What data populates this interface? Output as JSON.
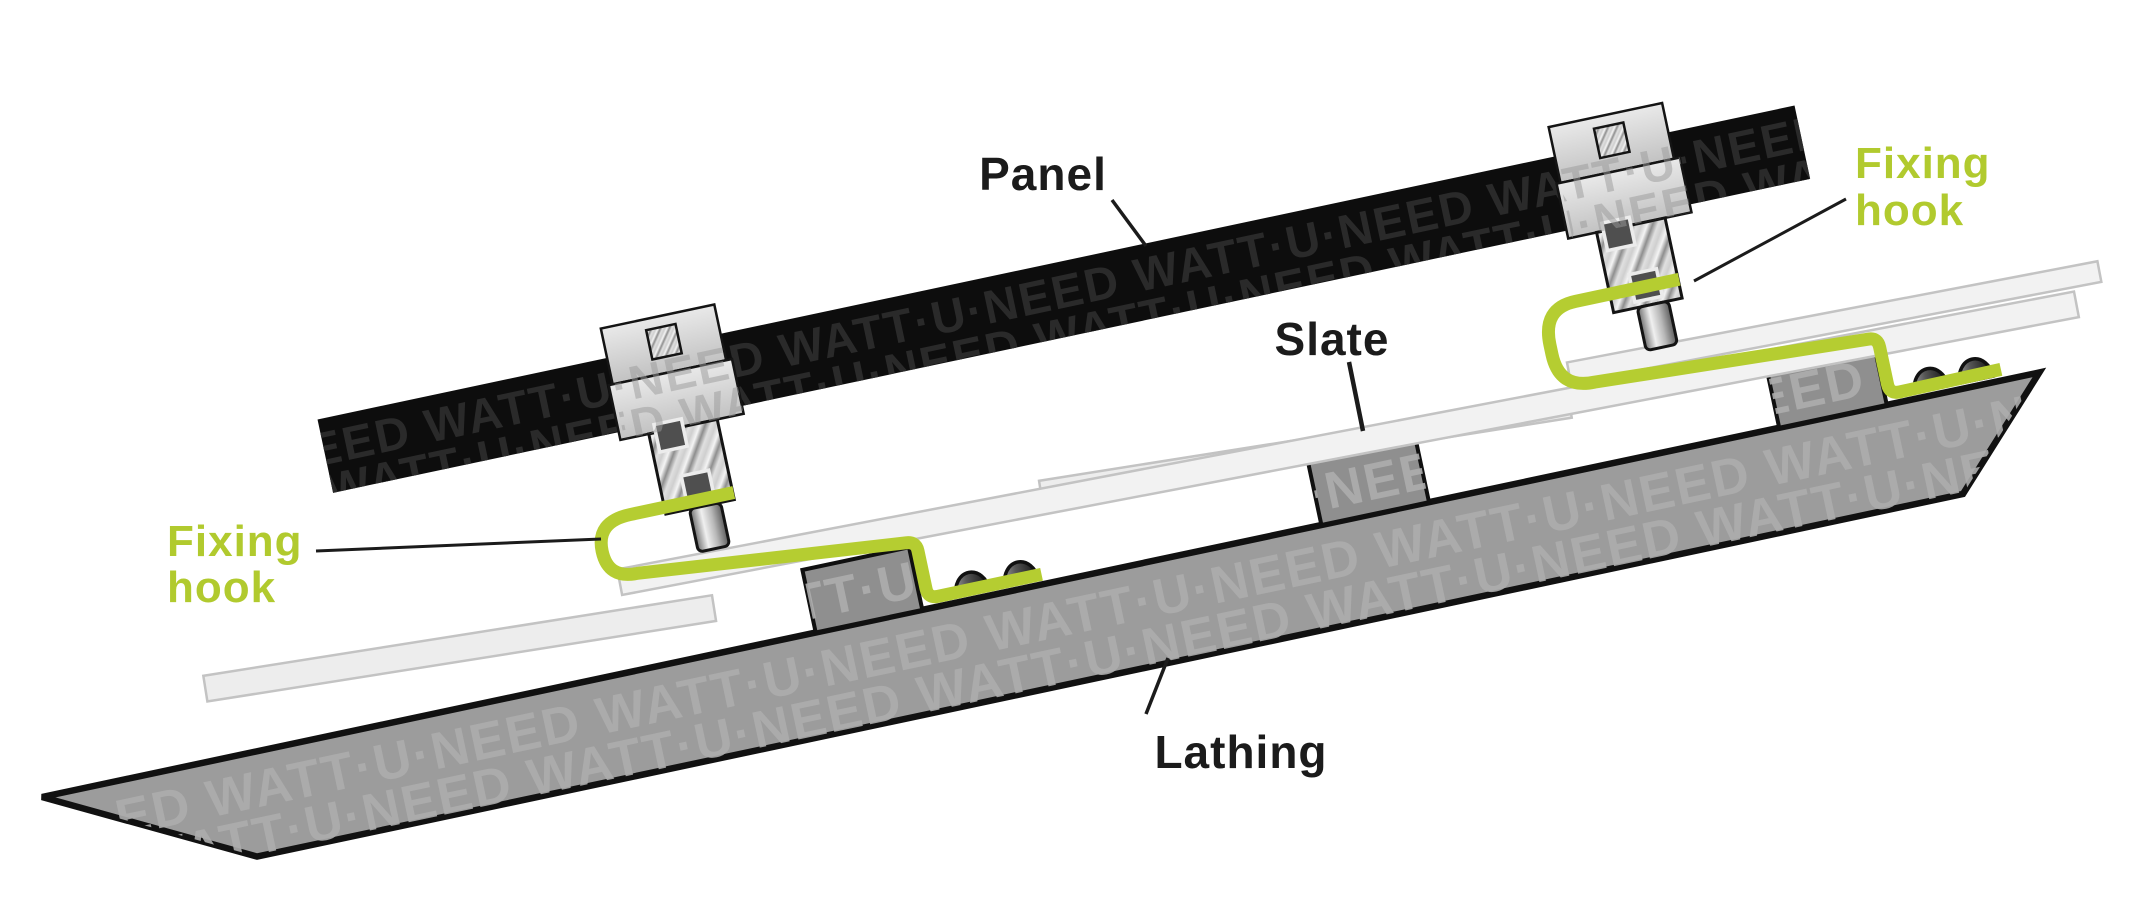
{
  "scene": {
    "width": 2154,
    "height": 921,
    "background": "#ffffff",
    "title": "Slate roof fixing hook mounting diagram"
  },
  "labels": {
    "panel": {
      "text": "Panel",
      "color": "#1b1b1b"
    },
    "slate": {
      "text": "Slate",
      "color": "#1b1b1b"
    },
    "lathing": {
      "text": "Lathing",
      "color": "#1b1b1b"
    },
    "fixing_hook_left": {
      "line1": "Fixing",
      "line2": "hook",
      "color": "#b1ca2e"
    },
    "fixing_hook_right": {
      "line1": "Fixing",
      "line2": "hook",
      "color": "#b1ca2e"
    }
  },
  "watermark": {
    "brand": "WATT·U·NEED",
    "panel_tile": "NEED WATT·U·NEED WATT·U·NEED WATT·U·NEED WATT·U·NEED WATT·U·NEED",
    "wood_tile": "ED WATT·U·NEED WATT·U·NEED WATT·U·NEED WATT·U·NEED WATT·U·NEED WATT·U·NE"
  },
  "colors": {
    "hook_green": "#b5cd31",
    "label_dark": "#1b1b1b",
    "leader_line": "#1b1b1b",
    "panel_black": "#0d0d0d",
    "panel_watermark": "#2a2a2a",
    "lathing_gray": "#9c9c9c",
    "wood_watermark": "#adadad",
    "batten_gray": "#8f8f8f",
    "slate_light": "#f2f2f2",
    "slate_dim": "#ededed",
    "slate_border": "#c3c3c3",
    "outline_black": "#111111",
    "clamp_light": "#d6d6d6"
  },
  "components": {
    "panel_count": 1,
    "clamp_count": 2,
    "fixing_hook_count": 2,
    "slate_count": 4,
    "batten_count": 3,
    "screw_count": 4
  }
}
